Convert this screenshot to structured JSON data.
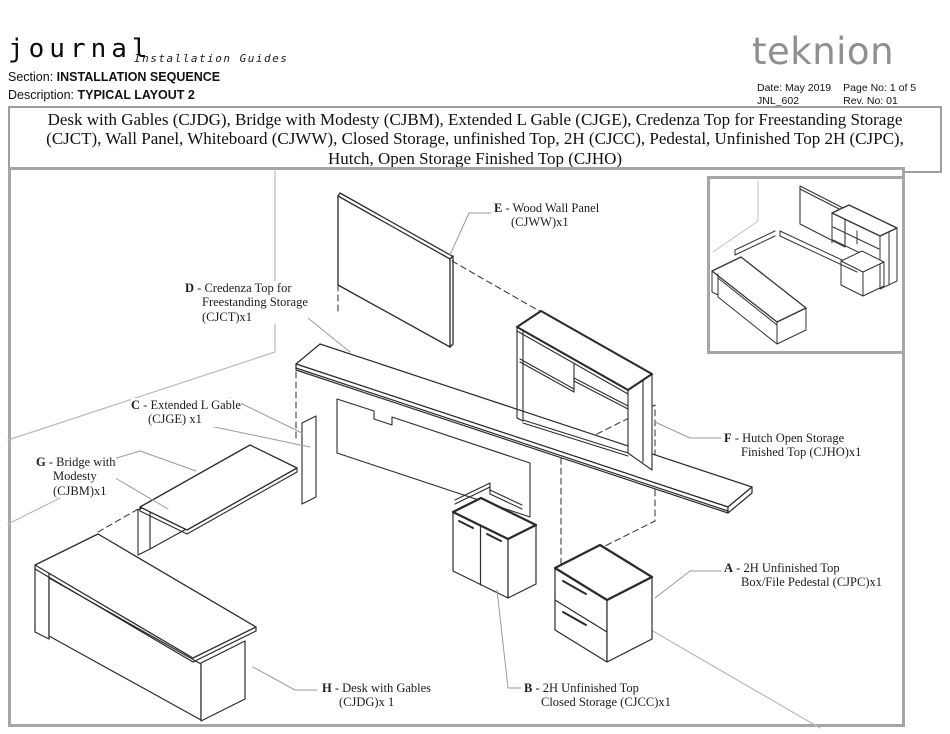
{
  "header": {
    "brand": "journal",
    "brand_sub": "Installation Guides",
    "section_label": "Section:",
    "section_value": "INSTALLATION SEQUENCE",
    "description_label": "Description:",
    "description_value": "TYPICAL LAYOUT 2",
    "logo": "teknion",
    "meta": {
      "date_label": "Date:",
      "date_value": "May 2019",
      "doc_code": "JNL_602",
      "page_label": "Page No:",
      "page_value": "1 of 5",
      "rev_label": "Rev. No:",
      "rev_value": "01"
    }
  },
  "title_block": {
    "lines": [
      "Desk with Gables (CJDG), Bridge with Modesty (CJBM), Extended L Gable (CJGE), Credenza Top for Freestanding Storage",
      "(CJCT), Wall Panel, Whiteboard (CJWW), Closed Storage, unfinished Top, 2H (CJCC), Pedestal, Unfinished Top 2H (CJPC),",
      "Hutch, Open Storage Finished Top (CJHO)"
    ]
  },
  "diagram": {
    "separator": " - ",
    "labels": [
      {
        "letter": "A",
        "lines": [
          "2H Unfinished Top",
          "Box/File Pedestal (CJPC)x1"
        ]
      },
      {
        "letter": "B",
        "lines": [
          "2H Unfinished Top",
          "Closed Storage (CJCC)x1"
        ]
      },
      {
        "letter": "C",
        "lines": [
          "Extended L Gable",
          "(CJGE) x1"
        ]
      },
      {
        "letter": "D",
        "lines": [
          "Credenza Top for",
          "Freestanding Storage",
          "(CJCT)x1"
        ]
      },
      {
        "letter": "E",
        "lines": [
          "Wood Wall Panel",
          "(CJWW)x1"
        ]
      },
      {
        "letter": "F",
        "lines": [
          "Hutch Open Storage",
          "Finished Top (CJHO)x1"
        ]
      },
      {
        "letter": "G",
        "lines": [
          "Bridge with",
          "Modesty",
          "(CJBM)x1"
        ]
      },
      {
        "letter": "H",
        "lines": [
          "Desk with Gables",
          "(CJDG)x 1"
        ]
      }
    ]
  },
  "colors": {
    "line": "#2b2b2b",
    "leader_gray": "#9a9a9a",
    "room_gray": "#b9b9b9",
    "border_gray": "#a6a6a6",
    "logo_gray": "#8f8f8f"
  }
}
